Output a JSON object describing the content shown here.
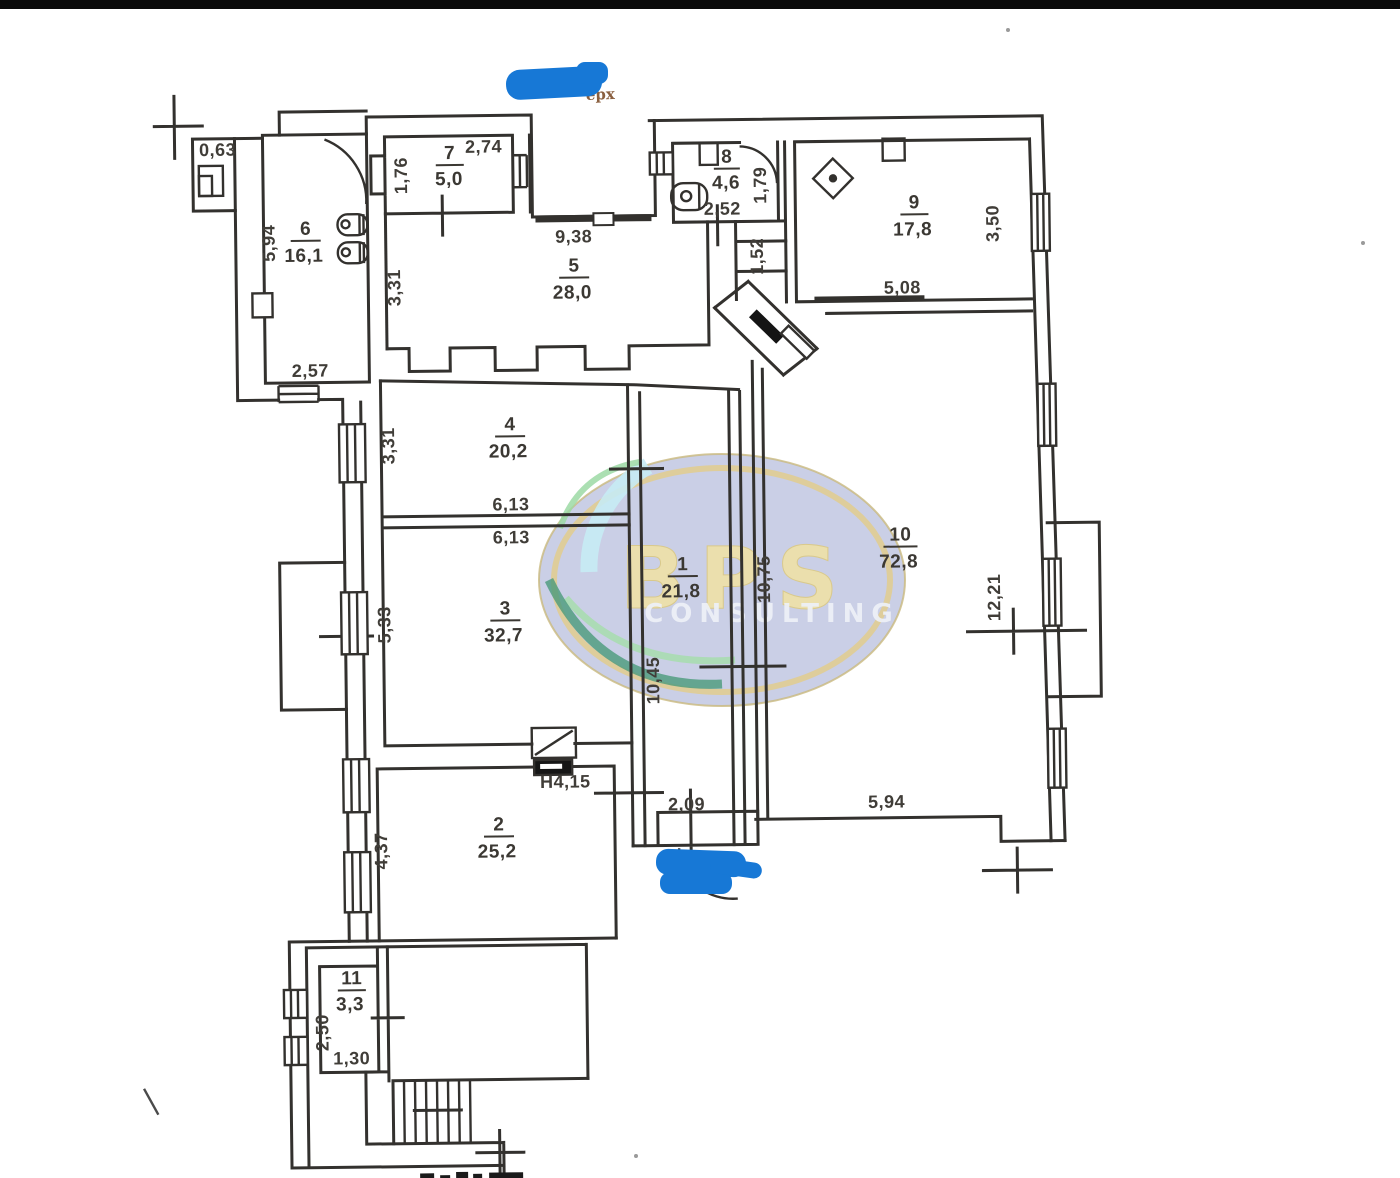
{
  "scan": {
    "redaction_remnant": "ерх"
  },
  "watermark": {
    "line1": "BPS",
    "line2": "CONSULTING"
  },
  "colors": {
    "ink": "#33312e",
    "redaction_blue": "#1778d6",
    "oval_fill": "#b5bcdc",
    "ring": "#e0cc92"
  },
  "rooms": [
    {
      "num": "1",
      "area": "21,8"
    },
    {
      "num": "2",
      "area": "25,2"
    },
    {
      "num": "3",
      "area": "32,7"
    },
    {
      "num": "4",
      "area": "20,2"
    },
    {
      "num": "5",
      "area": "28,0"
    },
    {
      "num": "6",
      "area": "16,1"
    },
    {
      "num": "7",
      "area": "5,0"
    },
    {
      "num": "8",
      "area": "4,6"
    },
    {
      "num": "9",
      "area": "17,8"
    },
    {
      "num": "10",
      "area": "72,8"
    },
    {
      "num": "11",
      "area": "3,3"
    }
  ],
  "dims": {
    "d063": "0,63",
    "d594_left": "5,94",
    "d257": "2,57",
    "d176": "1,76",
    "d274": "2,74",
    "d938": "9,38",
    "d331_top": "3,31",
    "d252": "2,52",
    "d179": "1,79",
    "d152": "1,52",
    "d508": "5,08",
    "d350": "3,50",
    "d331_mid": "3,31",
    "d613_a": "6,13",
    "d613_b": "6,13",
    "d533": "5,33",
    "d1045": "10,45",
    "d1075": "10,75",
    "d1221": "12,21",
    "d594_bottom": "5,94",
    "dh415": "H4,15",
    "d209": "2,09",
    "d437": "4,37",
    "d250": "2,50",
    "d130": "1,30"
  }
}
